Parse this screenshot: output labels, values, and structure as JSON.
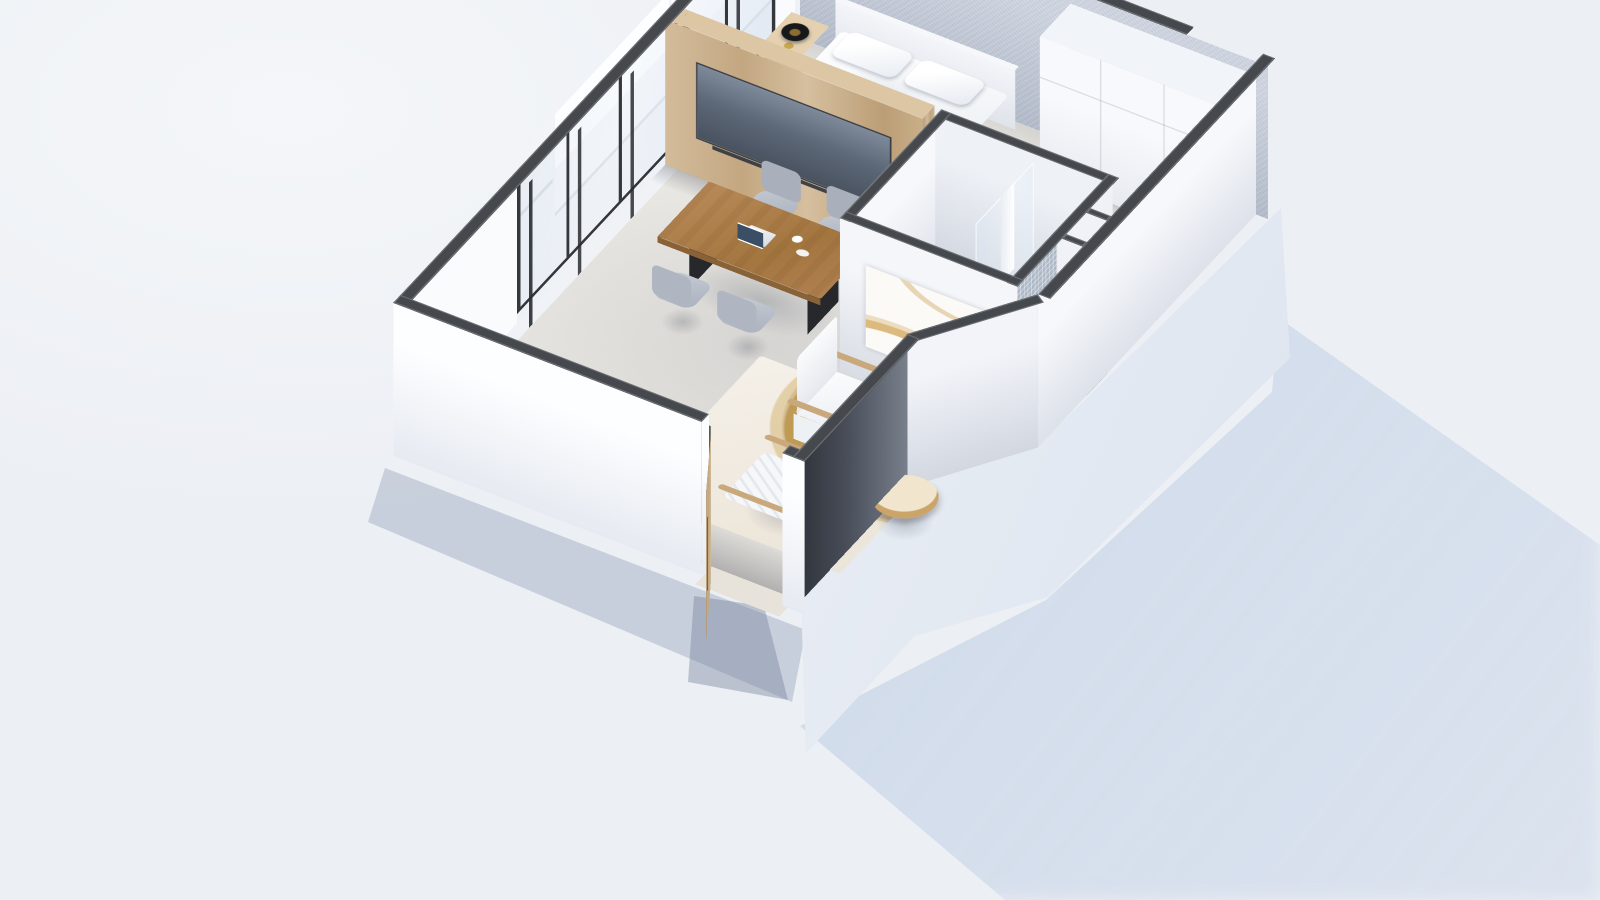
{
  "app": {
    "type": "3d-floor-plan-render",
    "view": "axonometric cutaway (dollhouse) view of a studio apartment",
    "background_color": "#eceff4",
    "ground_shadow_color": "#c3d2e6"
  },
  "palette": {
    "wall_cut_top": "#45484d",
    "wall_interior": "#f6f8fb",
    "wall_exterior": "#fdfeff",
    "accent_wall_fabric_gray": "#c3cad6",
    "wood_oak": "#c9ad8a",
    "floor": "#e9e7e2",
    "tv_screen": "#5c6674",
    "table_wood": "#a97b4e",
    "chair_gray": "#b4bac4",
    "rug_gold": "#c0954e",
    "mosaic_tile": "#aeb9c7",
    "shadow_blue": "#c3d2e6"
  },
  "rooms": [
    {
      "name": "Bedroom",
      "items": [
        "double bed with white duvet",
        "two pillows",
        "headboard",
        "gray fabric accent wall",
        "wooden nightstand",
        "black round table lamp",
        "gold trinket dish",
        "white wardrobe unit",
        "window with white roller blind"
      ]
    },
    {
      "name": "Bathroom",
      "items": [
        "walk-in shower",
        "glass shower screen",
        "white hanging towel",
        "blue mosaic tile wall and floor",
        "shower column",
        "service shaft niche",
        "abstract artwork on outer wall"
      ]
    },
    {
      "name": "Living / Dining",
      "items": [
        "wooden dining table",
        "five gray chairs",
        "open laptop",
        "coffee cup and saucer",
        "oak tv partition wall",
        "wall tv with soundbar",
        "white armchair",
        "white slatted lounge chair",
        "dark round coffee table",
        "rattan tray side table",
        "abstract gold area rug",
        "console desk with dark leaning panels",
        "two desk chairs",
        "potted plant",
        "open wooden entry door with black pull handle",
        "full-height windows with roller blinds"
      ]
    }
  ]
}
